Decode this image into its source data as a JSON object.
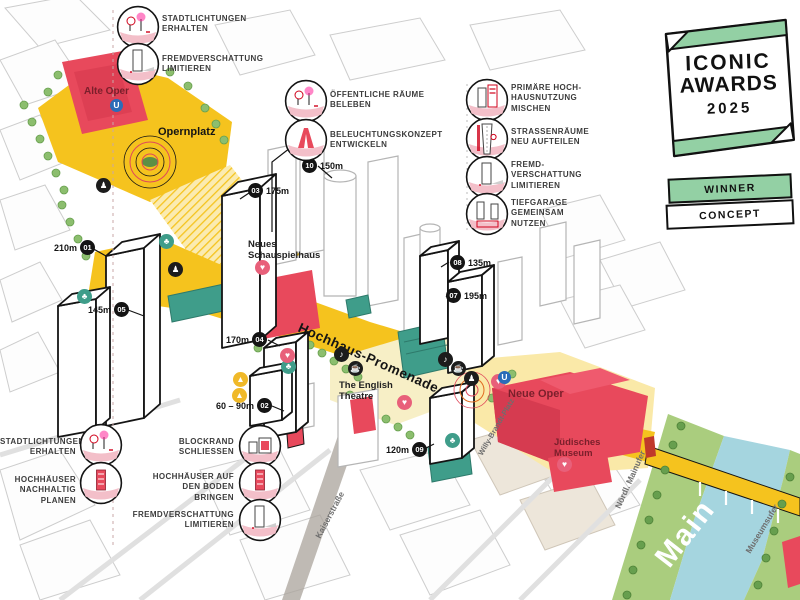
{
  "award": {
    "title_line1": "ICONIC",
    "title_line2": "AWARDS",
    "year": "2025",
    "ribbon_winner": "WINNER",
    "ribbon_concept": "CONCEPT"
  },
  "annotations": {
    "top_left": [
      {
        "label": "STADTLICHTUNGEN\nERHALTEN",
        "icon": "city-clearing-icon"
      },
      {
        "label": "FREMDVERSCHATTUNG\nLIMITIEREN",
        "icon": "shadow-tower-icon"
      }
    ],
    "center_top": [
      {
        "label": "ÖFFENTLICHE RÄUME\nBELEBEN",
        "icon": "public-space-icon"
      },
      {
        "label": "BELEUCHTUNGSKONZEPT\nENTWICKELN",
        "icon": "lighting-icon"
      }
    ],
    "right": [
      {
        "label": "PRIMÄRE HOCH-\nHAUSNUTZUNG\nMISCHEN",
        "icon": "mixed-use-icon"
      },
      {
        "label": "STRASSENRÄUME\nNEU AUFTEILEN",
        "icon": "street-space-icon"
      },
      {
        "label": "FREMD-\nVERSCHATTUNG\nLIMITIEREN",
        "icon": "shadow-tower-icon"
      },
      {
        "label": "TIEFGARAGE\nGEMEINSAM\nNUTZEN",
        "icon": "garage-icon"
      }
    ],
    "bottom_left": [
      {
        "label": "STADTLICHTUNGEN\nERHALTEN",
        "icon": "city-clearing-icon"
      },
      {
        "label": "HOCHHÄUSER\nNACHHALTIG PLANEN",
        "icon": "sustainable-tower-icon"
      },
      {
        "label": "BLOCKRAND\nSCHLIESSEN",
        "icon": "block-icon"
      },
      {
        "label": "HOCHHÄUSER AUF\nDEN BODEN BRINGEN",
        "icon": "grounded-tower-icon"
      },
      {
        "label": "FREMDVERSCHATTUNG\nLIMITIEREN",
        "icon": "shadow-tower-icon"
      }
    ]
  },
  "height_markers": [
    {
      "num": "01",
      "height": "210m"
    },
    {
      "num": "02",
      "height": "60 – 90m"
    },
    {
      "num": "03",
      "height": "175m"
    },
    {
      "num": "04",
      "height": "170m"
    },
    {
      "num": "05",
      "height": "145m"
    },
    {
      "num": "07",
      "height": "195m"
    },
    {
      "num": "08",
      "height": "135m"
    },
    {
      "num": "09",
      "height": "120m"
    },
    {
      "num": "10",
      "height": "150m"
    }
  ],
  "places": {
    "alte_oper": "Alte Oper",
    "opernplatz": "Opernplatz",
    "neues_schauspielhaus": "Neues\nSchauspielhaus",
    "hochhaus_promenade": "Hochhaus-Promenade",
    "english_theatre": "The English\nTheatre",
    "neue_oper": "Neue Oper",
    "juedisches_museum": "Jüdisches\nMuseum",
    "river": "Main"
  },
  "streets": {
    "kaiserstrasse": "Kaiserstraße",
    "willy_brandt_platz": "Willy-Brandt-Platz",
    "noerdl_mainufer": "Nördl. Mainufer",
    "museumsufer": "Museumsufer"
  },
  "icons": [
    {
      "name": "pedestrian-icon",
      "glyph": "♟"
    },
    {
      "name": "pedestrian-icon",
      "glyph": "♟"
    },
    {
      "name": "music-icon",
      "glyph": "♪"
    },
    {
      "name": "cafe-icon",
      "glyph": "☕"
    },
    {
      "name": "music-icon",
      "glyph": "♪"
    },
    {
      "name": "cafe-icon",
      "glyph": "☕"
    },
    {
      "name": "pedestrian-icon",
      "glyph": "♟"
    },
    {
      "name": "tree-icon",
      "glyph": "♣"
    },
    {
      "name": "tree-icon",
      "glyph": "♣"
    },
    {
      "name": "tree-icon",
      "glyph": "♣"
    },
    {
      "name": "tree-icon",
      "glyph": "♣"
    },
    {
      "name": "culture-icon",
      "glyph": "♥"
    },
    {
      "name": "culture-icon",
      "glyph": "♥"
    },
    {
      "name": "culture-icon",
      "glyph": "♥"
    },
    {
      "name": "culture-icon",
      "glyph": "♥"
    },
    {
      "name": "culture-icon",
      "glyph": "♥"
    },
    {
      "name": "play-icon",
      "glyph": "▲"
    },
    {
      "name": "play-icon",
      "glyph": "▲"
    },
    {
      "name": "ubahn-icon",
      "glyph": "U"
    },
    {
      "name": "ubahn-icon",
      "glyph": "U"
    }
  ],
  "colors": {
    "promenade_yellow": "#F5C31E",
    "pale_yellow": "#FAE9A8",
    "building_red": "#E8495C",
    "accent_teal": "#3F9D8A",
    "tree_green": "#8CBE6E",
    "bank_green": "#AACD7E",
    "river_blue": "#A5D5DF",
    "award_green": "#93D0A4",
    "line_gray": "#C9C9C9",
    "ink": "#141414"
  }
}
